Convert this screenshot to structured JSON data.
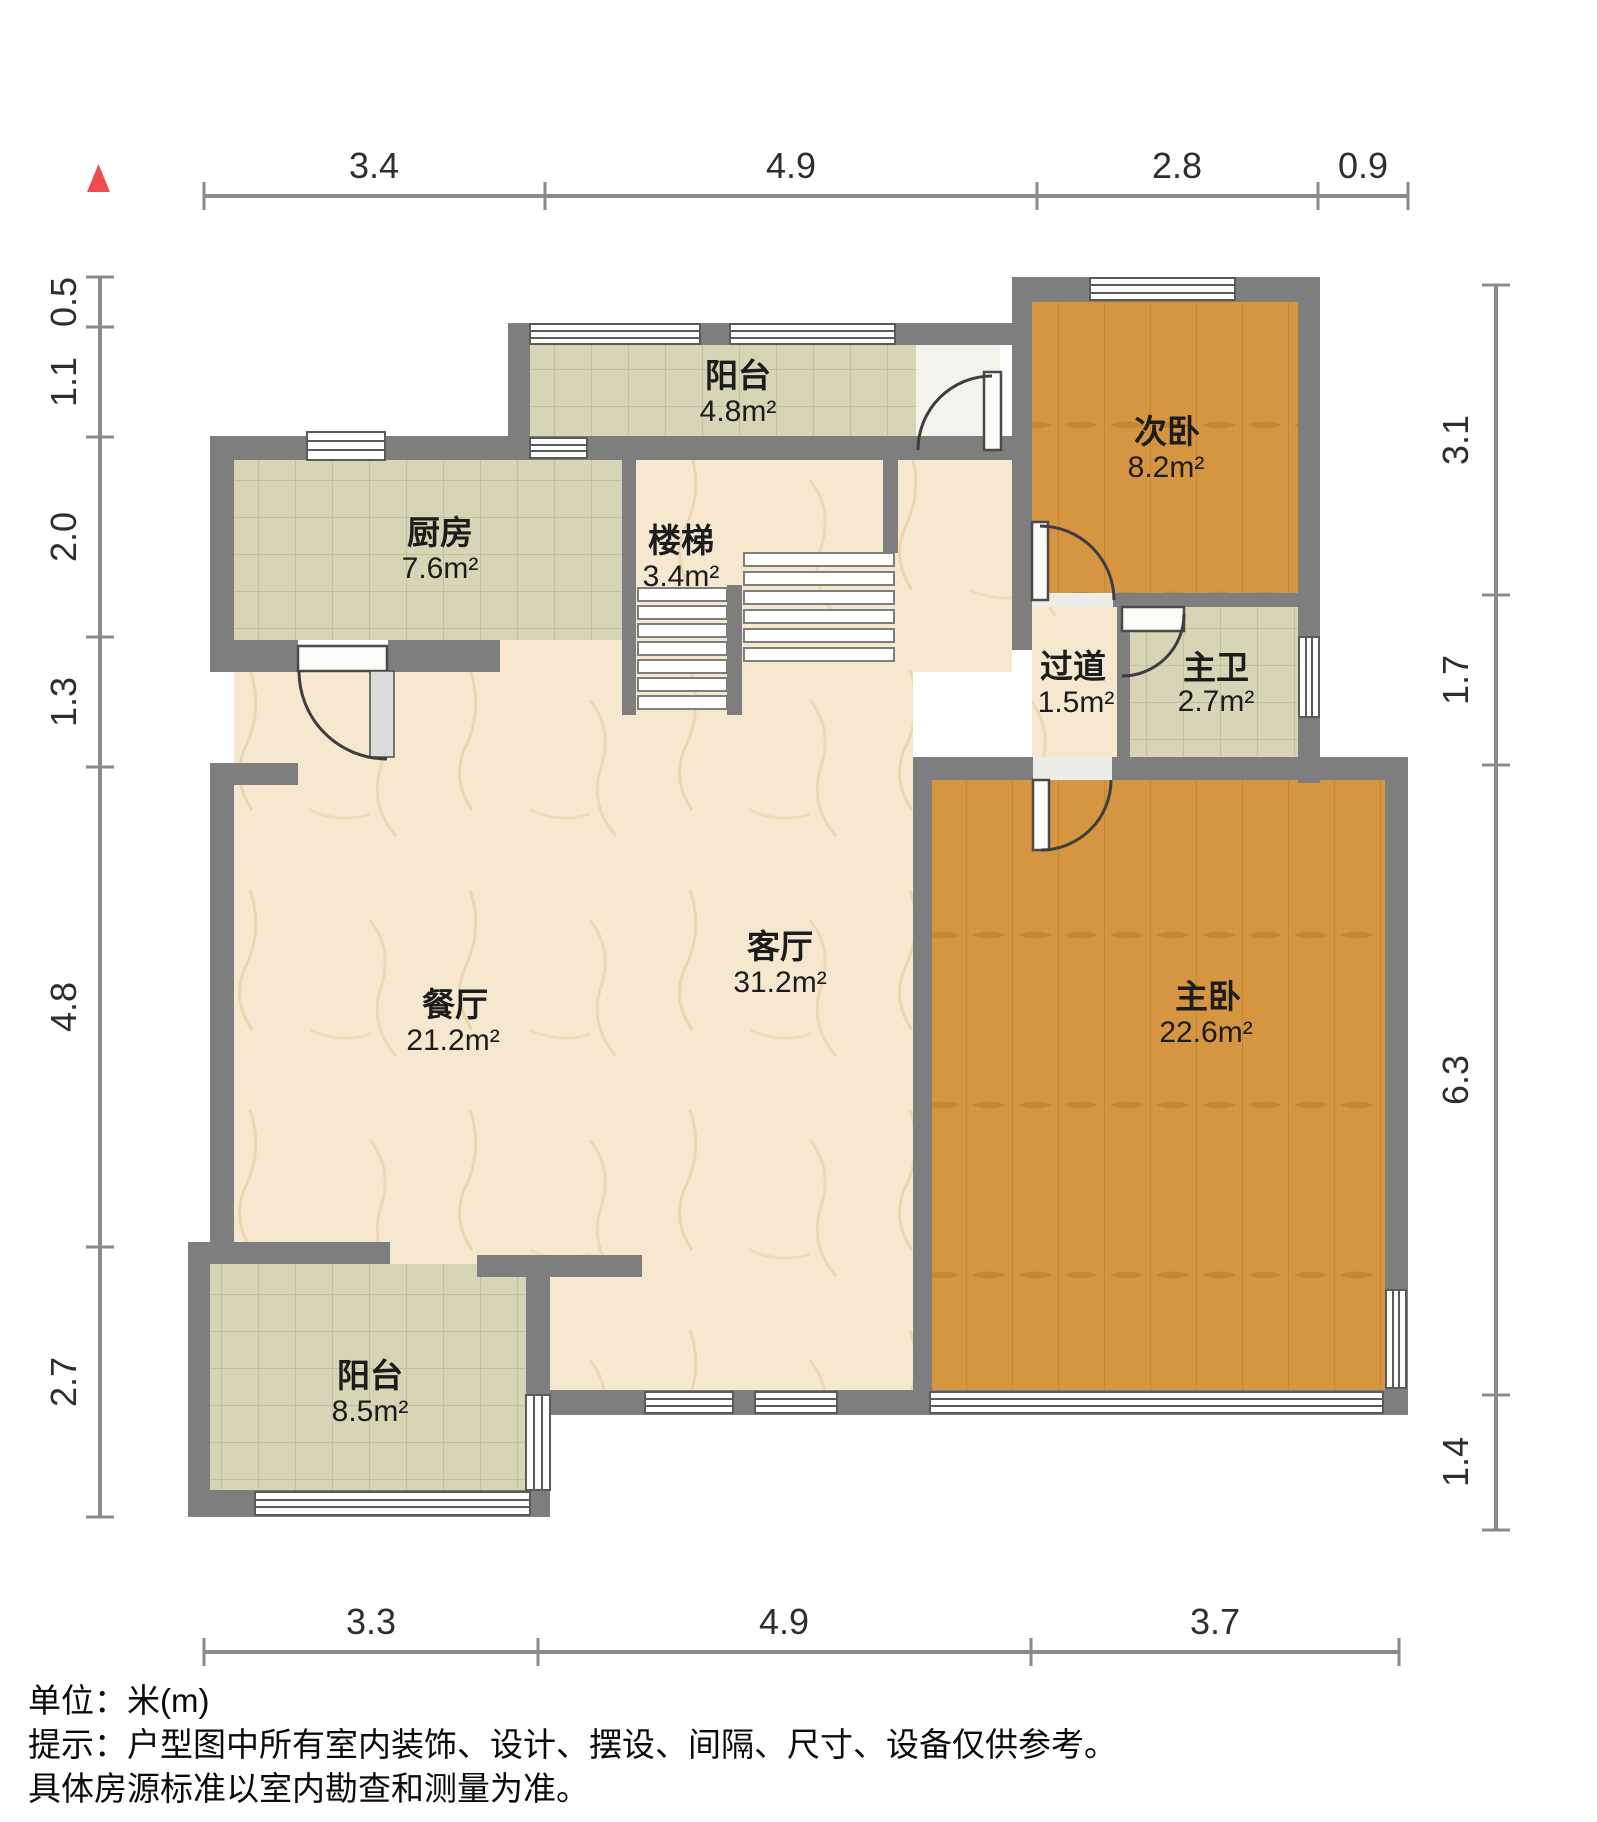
{
  "plan": {
    "type": "residential-floor-plan",
    "rooms": [
      {
        "id": "balcony-top",
        "name": "阳台",
        "area": "4.8m²"
      },
      {
        "id": "secondary-bedroom",
        "name": "次卧",
        "area": "8.2m²"
      },
      {
        "id": "kitchen",
        "name": "厨房",
        "area": "7.6m²"
      },
      {
        "id": "stairs",
        "name": "楼梯",
        "area": "3.4m²"
      },
      {
        "id": "hallway",
        "name": "过道",
        "area": "1.5m²"
      },
      {
        "id": "master-bath",
        "name": "主卫",
        "area": "2.7m²"
      },
      {
        "id": "living-room",
        "name": "客厅",
        "area": "31.2m²"
      },
      {
        "id": "dining-room",
        "name": "餐厅",
        "area": "21.2m²"
      },
      {
        "id": "master-bedroom",
        "name": "主卧",
        "area": "22.6m²"
      },
      {
        "id": "balcony-bottom",
        "name": "阳台",
        "area": "8.5m²"
      }
    ],
    "dims": {
      "top": [
        "3.4",
        "4.9",
        "2.8",
        "0.9"
      ],
      "bottom": [
        "3.3",
        "4.9",
        "3.7"
      ],
      "left": [
        "0.5",
        "1.1",
        "2.0",
        "1.3",
        "4.8",
        "2.7"
      ],
      "right": [
        "3.1",
        "1.7",
        "6.3",
        "1.4"
      ]
    },
    "notes": {
      "unit": "单位：米(m)",
      "tip1": "提示：户型图中所有室内装饰、设计、摆设、间隔、尺寸、设备仅供参考。",
      "tip2": "具体房源标准以室内勘查和测量为准。"
    },
    "colors": {
      "wall": "#7e7e7e",
      "floor_marble": "#f5e8cf",
      "floor_tile": "#d7d5b6",
      "floor_wood": "#d69540",
      "north_indicator": "#ee4d4d"
    },
    "icons": {
      "north": "north-indicator-triangle"
    }
  }
}
